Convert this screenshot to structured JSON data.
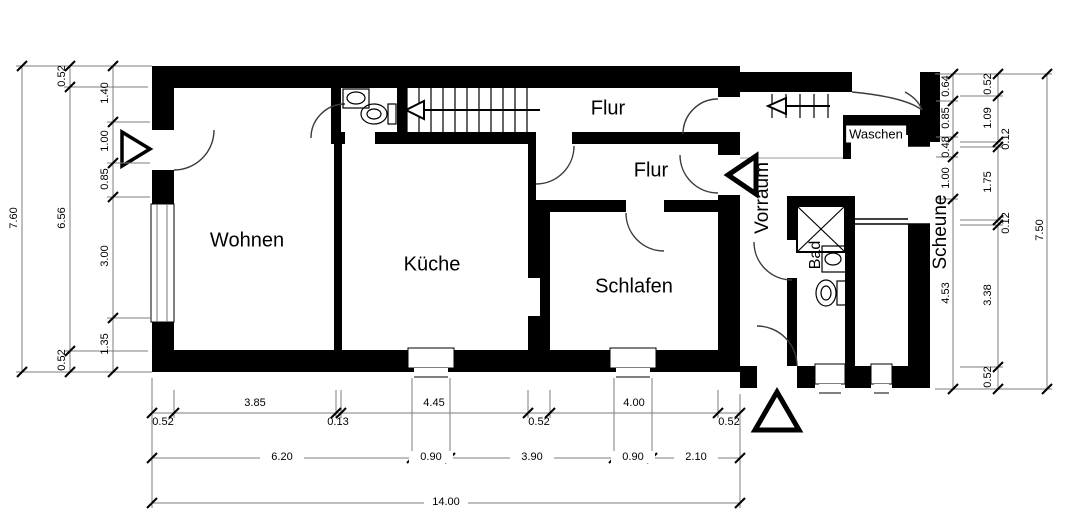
{
  "title": "Grundriss",
  "rooms": {
    "wohnen": "Wohnen",
    "kueche": "Küche",
    "schlafen": "Schlafen",
    "flur_upper": "Flur",
    "flur_lower": "Flur",
    "vorraum": "Vorraum",
    "bad": "Bad",
    "waschen": "Waschen",
    "scheune": "Scheune"
  },
  "icons": [
    "stair-arrow-icon",
    "entrance-arrow-icon",
    "toilet-icon",
    "sink-icon",
    "shower-icon",
    "window",
    "door-arc"
  ],
  "colors": {
    "wall": "#000000",
    "dimension_line": "#7d7d7d",
    "door_arc": "#3a3a3a",
    "background": "#ffffff"
  },
  "dims": {
    "left_total": "7.60",
    "left_outer": [
      "0.52",
      "6.56",
      "0.52"
    ],
    "left_inner": [
      "1.40",
      "1.00",
      "0.85",
      "3.00",
      "1.35"
    ],
    "bottom_row1": [
      "0.52",
      "3.85",
      "0.13",
      "4.45",
      "0.52",
      "4.00",
      "0.52"
    ],
    "bottom_row2": [
      "6.20",
      "0.90",
      "3.90",
      "0.90",
      "2.10"
    ],
    "bottom_total": "14.00",
    "right_inner": [
      "0.64",
      "0.85",
      "0.48",
      "1.00",
      "4.53"
    ],
    "right_middle": [
      "0.52",
      "1.09",
      "0.12",
      "1.75",
      "0.12",
      "3.38",
      "0.52"
    ],
    "right_total": "7.50"
  }
}
